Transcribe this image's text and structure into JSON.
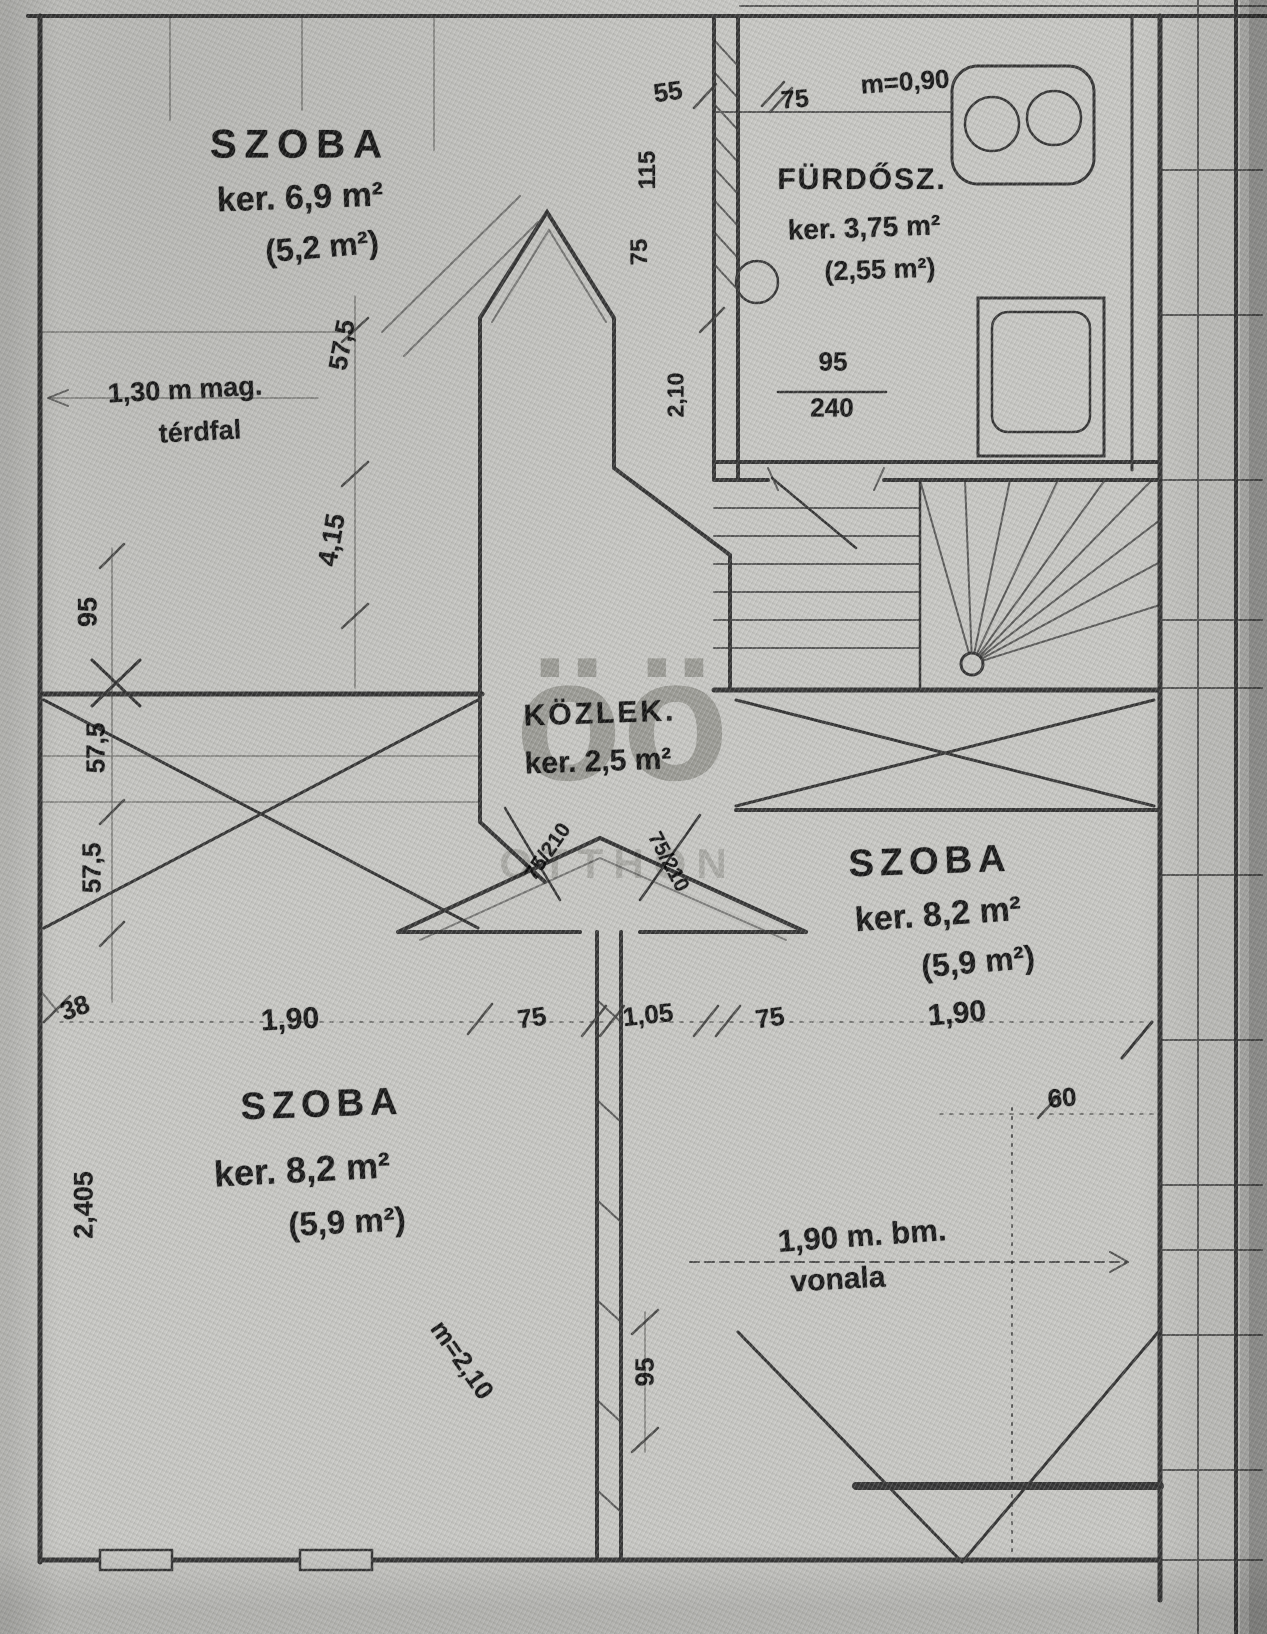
{
  "watermark": {
    "glyph": "öö",
    "text": "OTTHON"
  },
  "rooms": {
    "top_left": {
      "name": "SZOBA",
      "gross": "ker. 6,9 m²",
      "net": "(5,2 m²)"
    },
    "bathroom": {
      "name": "FÜRDŐSZ.",
      "gross": "ker. 3,75 m²",
      "net": "(2,55 m²)"
    },
    "hall": {
      "name": "KÖZLEK.",
      "gross": "ker. 2,5 m²"
    },
    "right": {
      "name": "SZOBA",
      "gross": "ker. 8,2 m²",
      "net": "(5,9 m²)"
    },
    "bottom_left": {
      "name": "SZOBA",
      "gross": "ker. 8,2 m²",
      "net": "(5,9 m²)"
    }
  },
  "notes": {
    "knee_wall_line1": "1,30 m mag.",
    "knee_wall_line2": "térdfal",
    "parapet": "m=0,90",
    "ceiling": "m=2,10",
    "height_line1": "1,90 m. bm.",
    "height_line2": "vonala"
  },
  "dimensions": {
    "top_55": "55",
    "top_115": "115",
    "top_75_v": "75",
    "top_75": "75",
    "bath_door_w": "95",
    "bath_door_h": "240",
    "bath_door_clear": "2,10",
    "left_95": "95",
    "left_575_a": "57,5",
    "left_575_b": "57,5",
    "left_38": "38",
    "left_2405": "2,405",
    "tl_575": "57,5",
    "tl_415": "4,15",
    "row_190_l": "1,90",
    "row_75_a": "75",
    "row_105": "1,05",
    "row_75_b": "75",
    "row_190_r": "1,90",
    "right_60": "60",
    "bottom_95": "95",
    "hall_door_a": "75/210",
    "hall_door_b": "75/210"
  }
}
